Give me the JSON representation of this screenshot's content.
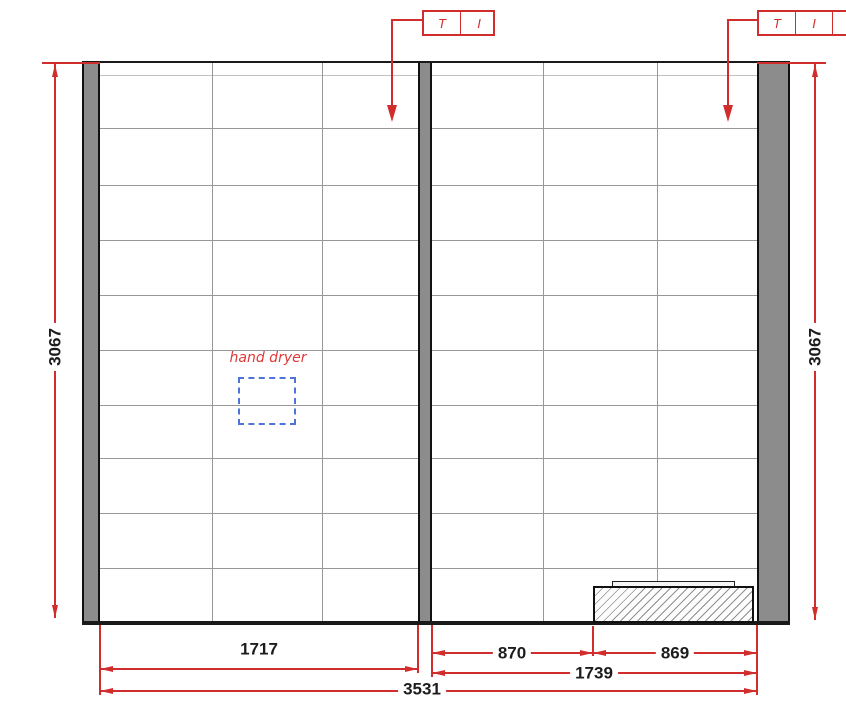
{
  "drawing": {
    "type": "tiled-wall-elevation",
    "annotations": {
      "hand_dryer": "hand dryer"
    },
    "callouts": {
      "left": {
        "cells": [
          "T",
          "I"
        ]
      },
      "right": {
        "cells": [
          "T",
          "I"
        ]
      }
    },
    "dimensions": {
      "left_height": "3067",
      "right_height": "3067",
      "bottom_left_width": "1717",
      "bottom_right_first": "870",
      "bottom_right_second": "869",
      "bottom_right_total": "1739",
      "bottom_total": "3531"
    },
    "colors": {
      "dimension_red": "#d22d2d",
      "annotation_blue": "#4f74d8",
      "wall_gray": "#8c8c8c",
      "line_black": "#1a1a1a",
      "grid_gray": "#979797"
    }
  }
}
